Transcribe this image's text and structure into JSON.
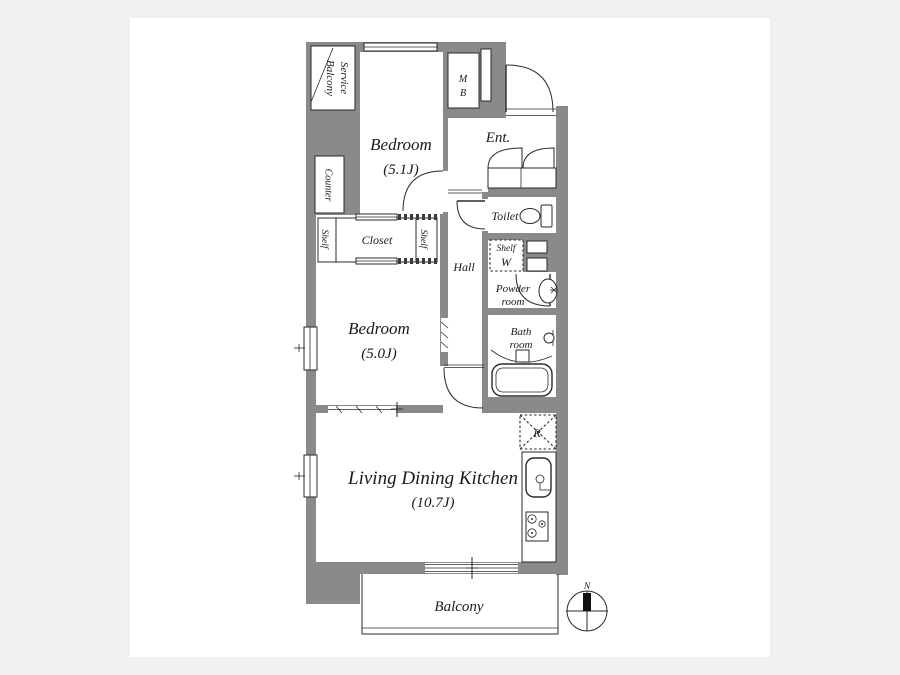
{
  "page": {
    "background_color": "#f0f0f0",
    "canvas_color": "#ffffff",
    "wall_color": "#8a8a8a",
    "line_color": "#2a2a2a"
  },
  "floorplan": {
    "rooms": {
      "service_balcony": {
        "label_line1": "Service",
        "label_line2": "Balcony"
      },
      "bedroom1": {
        "name": "Bedroom",
        "size": "(5.1J)"
      },
      "meter_box": {
        "line1": "M",
        "line2": "B"
      },
      "entrance": {
        "label": "Ent."
      },
      "toilet": {
        "label": "Toilet"
      },
      "counter": {
        "label": "Counter"
      },
      "closet": {
        "label": "Closet"
      },
      "shelf_left": {
        "label": "Shelf"
      },
      "shelf_right": {
        "label": "Shelf"
      },
      "hall": {
        "label": "Hall"
      },
      "laundry": {
        "shelf_label": "Shelf",
        "washer_label": "W"
      },
      "powder_room": {
        "line1": "Powder",
        "line2": "room"
      },
      "bathroom": {
        "line1": "Bath",
        "line2": "room"
      },
      "bedroom2": {
        "name": "Bedroom",
        "size": "(5.0J)"
      },
      "ldk": {
        "name": "Living Dining Kitchen",
        "size": "(10.7J)"
      },
      "refrigerator_space": {
        "label": "R"
      },
      "balcony": {
        "label": "Balcony"
      }
    },
    "compass": {
      "north_label": "N"
    }
  }
}
